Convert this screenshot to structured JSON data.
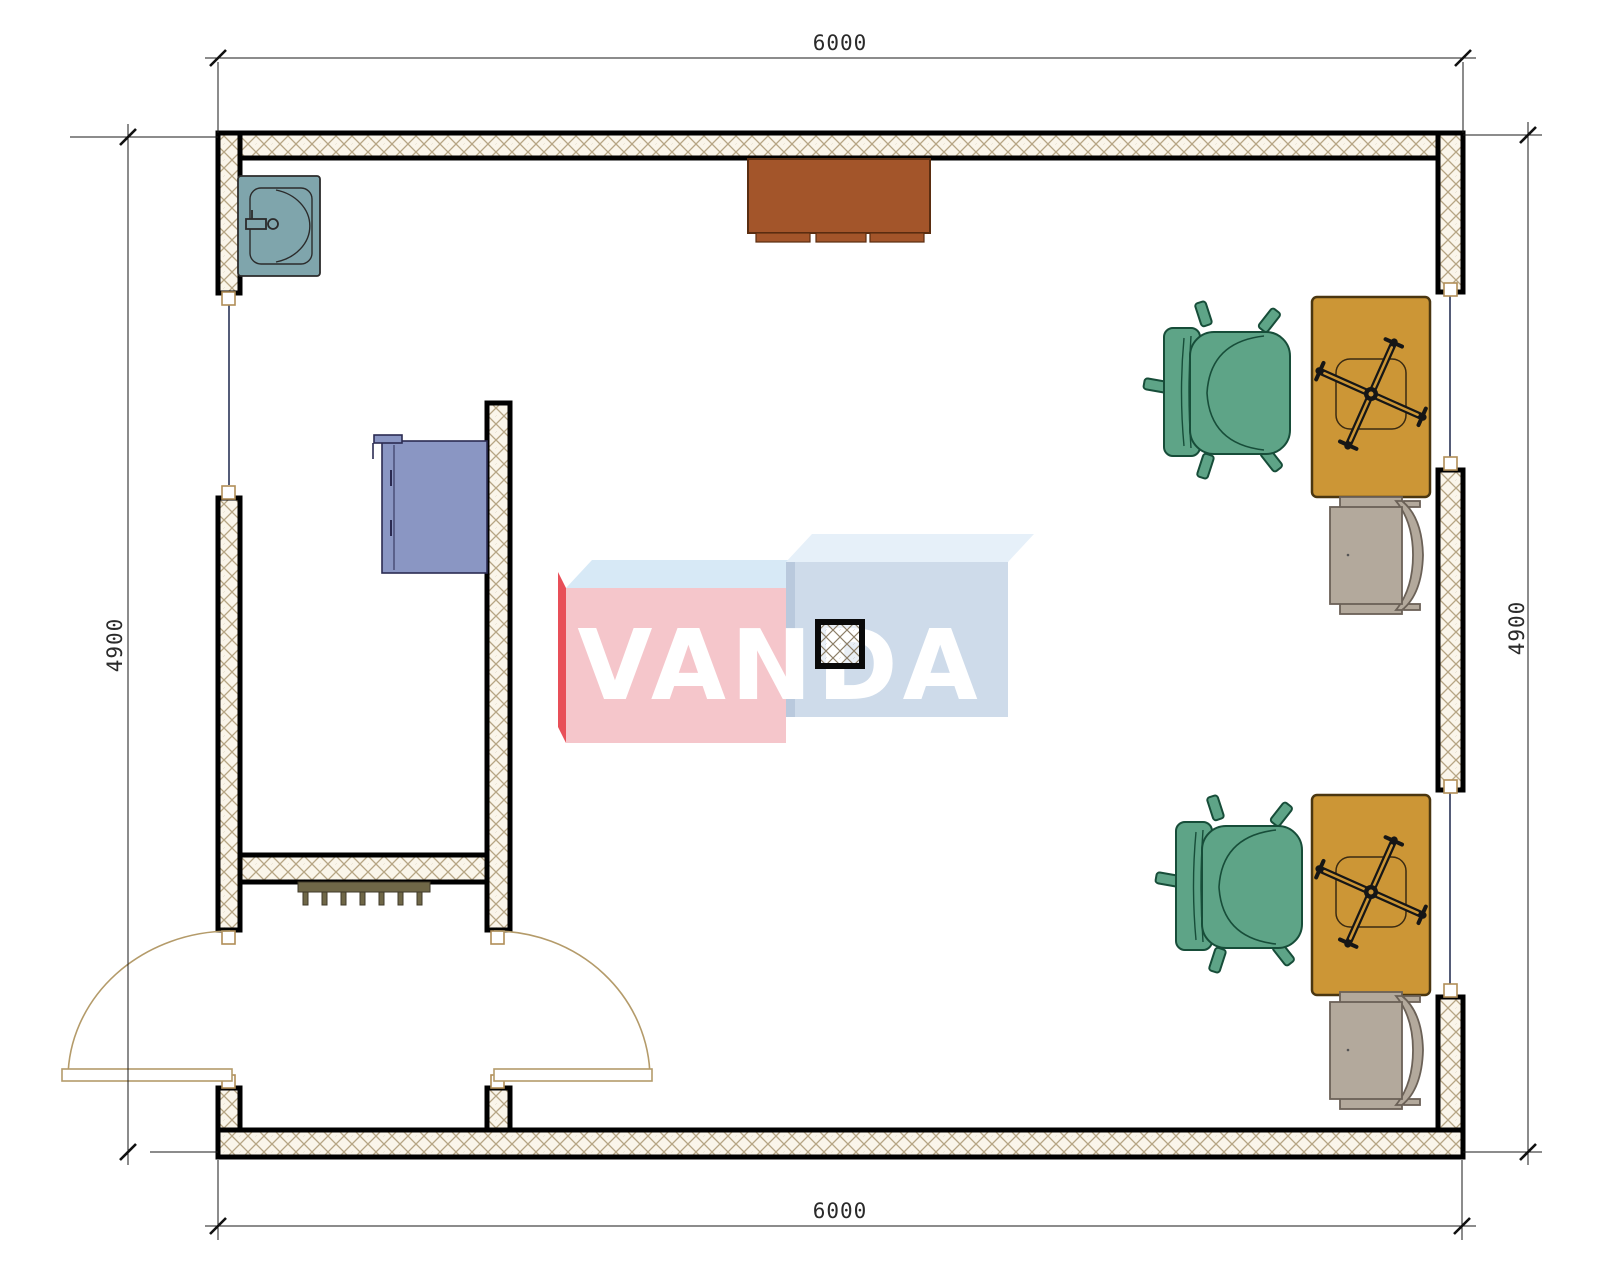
{
  "watermark": {
    "text": "VANDA",
    "text_color": "#ffffff",
    "left_box": {
      "front": "#f5c6cb",
      "top": "#d7e9f6",
      "side": "#e84f58"
    },
    "right_box": {
      "front": "#cedbea",
      "top": "#e6f0f9",
      "edge": "#b9c9dd"
    }
  },
  "dimensions": {
    "top": {
      "value": "6000"
    },
    "bottom": {
      "value": "6000"
    },
    "left": {
      "value": "4900"
    },
    "right": {
      "value": "4900"
    }
  },
  "plan": {
    "wall_border": "#000000",
    "wall_hatch_bg": "#faf5ea",
    "wall_hatch_line": "#b6a584",
    "window_line": "#2a3356",
    "frame_square": "#b08d57",
    "door_arc": "#b49b6a"
  },
  "furniture": {
    "sink": {
      "name": "sink",
      "color": "#7fa5ac"
    },
    "cabinet": {
      "name": "cabinet",
      "color": "#a3552a"
    },
    "wardrobe": {
      "name": "wardrobe",
      "color": "#8a96c3"
    },
    "radiator": {
      "name": "radiator",
      "color": "#6f6747"
    },
    "column": {
      "name": "column"
    },
    "desks": {
      "name": "desk",
      "color": "#cc9636"
    },
    "office_chairs": {
      "name": "office-chair",
      "color": "#5ea487"
    },
    "side_chairs": {
      "name": "side-chair",
      "color": "#b3a99c"
    }
  }
}
